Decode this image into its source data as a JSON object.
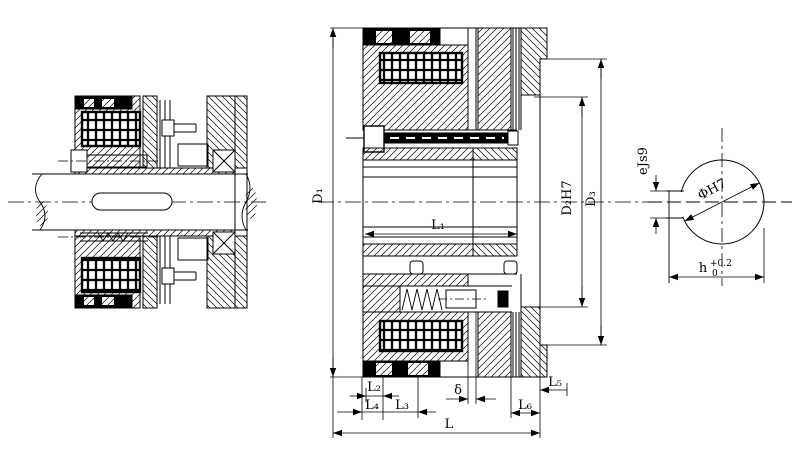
{
  "drawing": {
    "title": "electromagnetic-clutch-technical-drawing",
    "background_color": "#ffffff",
    "line_color": "#000000",
    "views": {
      "left_view": "assembled-clutch-on-shaft-section",
      "middle_view": "enlarged-clutch-half-section",
      "right_view": "shaft-bore-end-view"
    },
    "dimensions": {
      "d1": "D₁",
      "d2": "D₂H7",
      "d3": "D₃",
      "l1": "L₁",
      "l2": "L₂",
      "l3": "L₃",
      "l4": "L₄",
      "l5": "L₅",
      "l6": "L₆",
      "delta": "δ",
      "l": "L",
      "e": "eJs9",
      "phi": "ΦH7",
      "h_base": "h",
      "h_sup": "+0.2",
      "h_sub": "0"
    }
  }
}
